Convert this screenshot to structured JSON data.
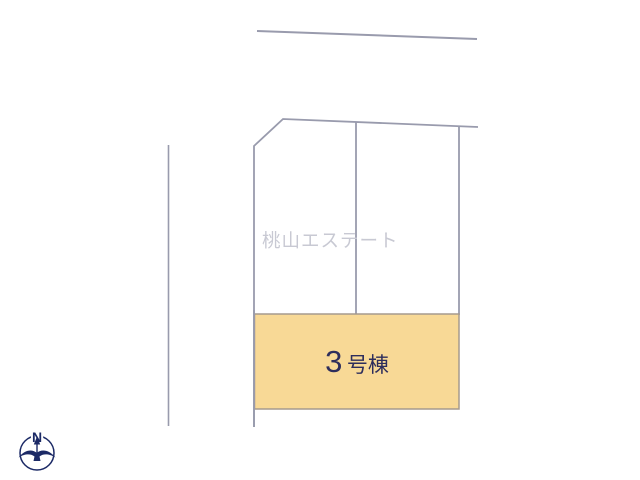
{
  "site_plan": {
    "watermark_text": "桃山エステート",
    "lot": {
      "number_label": "3",
      "suffix_label": "号棟",
      "full_label": "3号棟"
    },
    "colors": {
      "boundary_line": "#999bad",
      "lot_fill": "#f8d996",
      "lot_border": "#a59a8d",
      "lot_label_text": "#2e2e5c",
      "watermark_text": "#c8c9d3",
      "compass": "#1c2a66"
    }
  },
  "compass": {
    "north_label": "N"
  }
}
